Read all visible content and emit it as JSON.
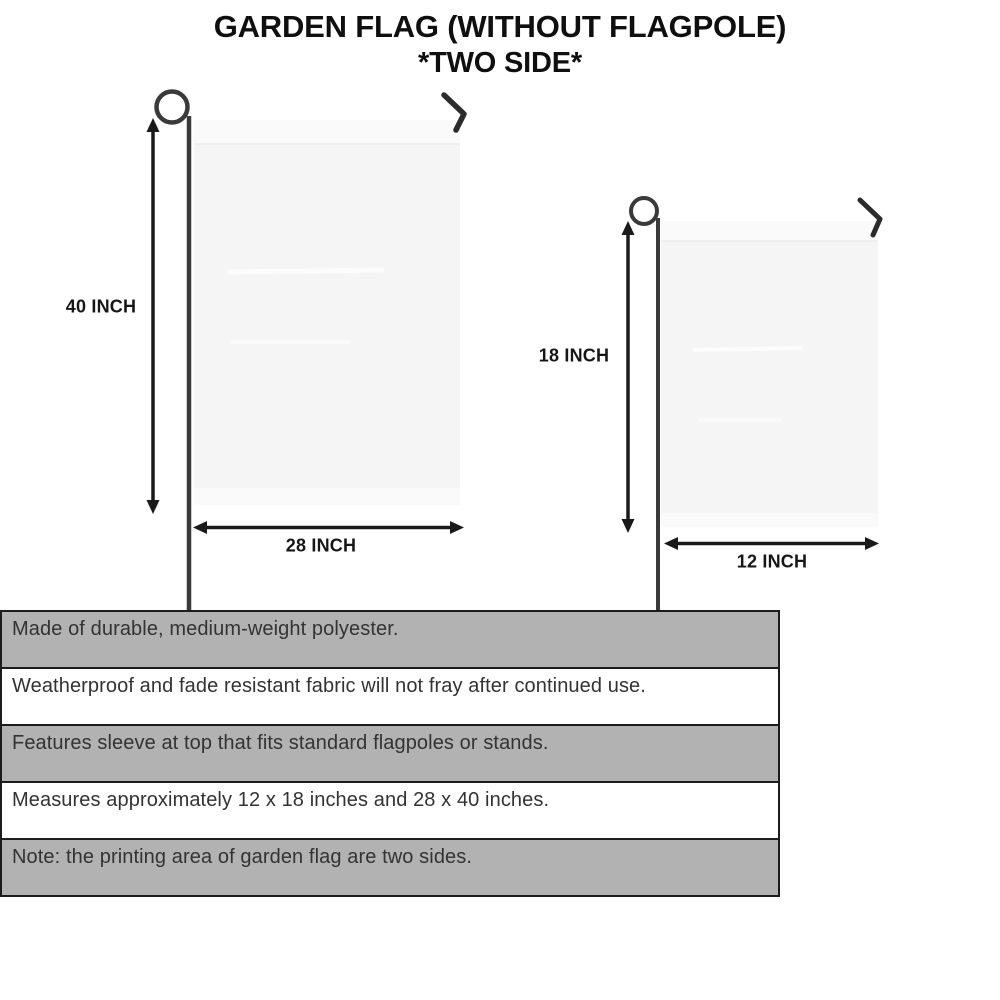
{
  "title": {
    "line1": "GARDEN FLAG (WITHOUT FLAGPOLE)",
    "line2": "*TWO SIDE*"
  },
  "diagram": {
    "large_flag": {
      "height_label": "40 INCH",
      "width_label": "28 INCH"
    },
    "small_flag": {
      "height_label": "18 INCH",
      "width_label": "12 INCH"
    }
  },
  "notes": [
    "Made of durable, medium-weight polyester.",
    "Weatherproof and fade resistant fabric will not fray after continued use.",
    "Features sleeve at top that fits standard flagpoles or stands.",
    "Measures approximately 12 x 18 inches and 28 x 40 inches.",
    "Note: the printing area of garden flag are two sides."
  ],
  "colors": {
    "note_stripe_gray": "#b2b2b2",
    "note_border": "#1c1c1c",
    "flag_fill": "#f5f5f5",
    "flag_sleeve": "#fafafa",
    "pole": "#3a3a3a",
    "arrow": "#1a1a1a",
    "title_text": "#0f0f0f"
  }
}
